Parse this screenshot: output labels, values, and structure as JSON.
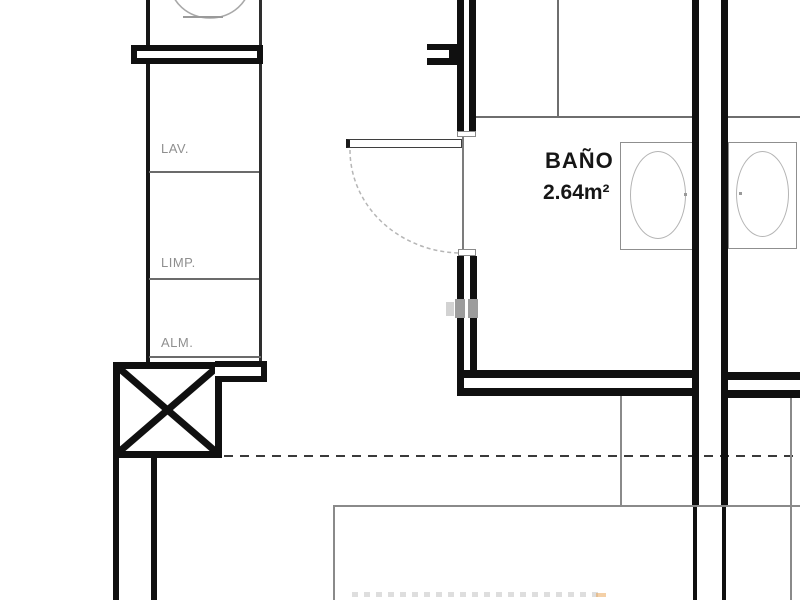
{
  "plan": {
    "labels": {
      "lav": "LAV.",
      "limp": "LIMP.",
      "alm": "ALM."
    },
    "bathroom": {
      "name": "BAÑO",
      "area": "2.64m²"
    },
    "colors": {
      "wall": "#101010",
      "thin_line": "#6e6e6e",
      "guide_line": "#8a8a8a",
      "light_line": "#b4b4b4",
      "label_text": "#8f8f8f",
      "room_text": "#161616"
    }
  }
}
